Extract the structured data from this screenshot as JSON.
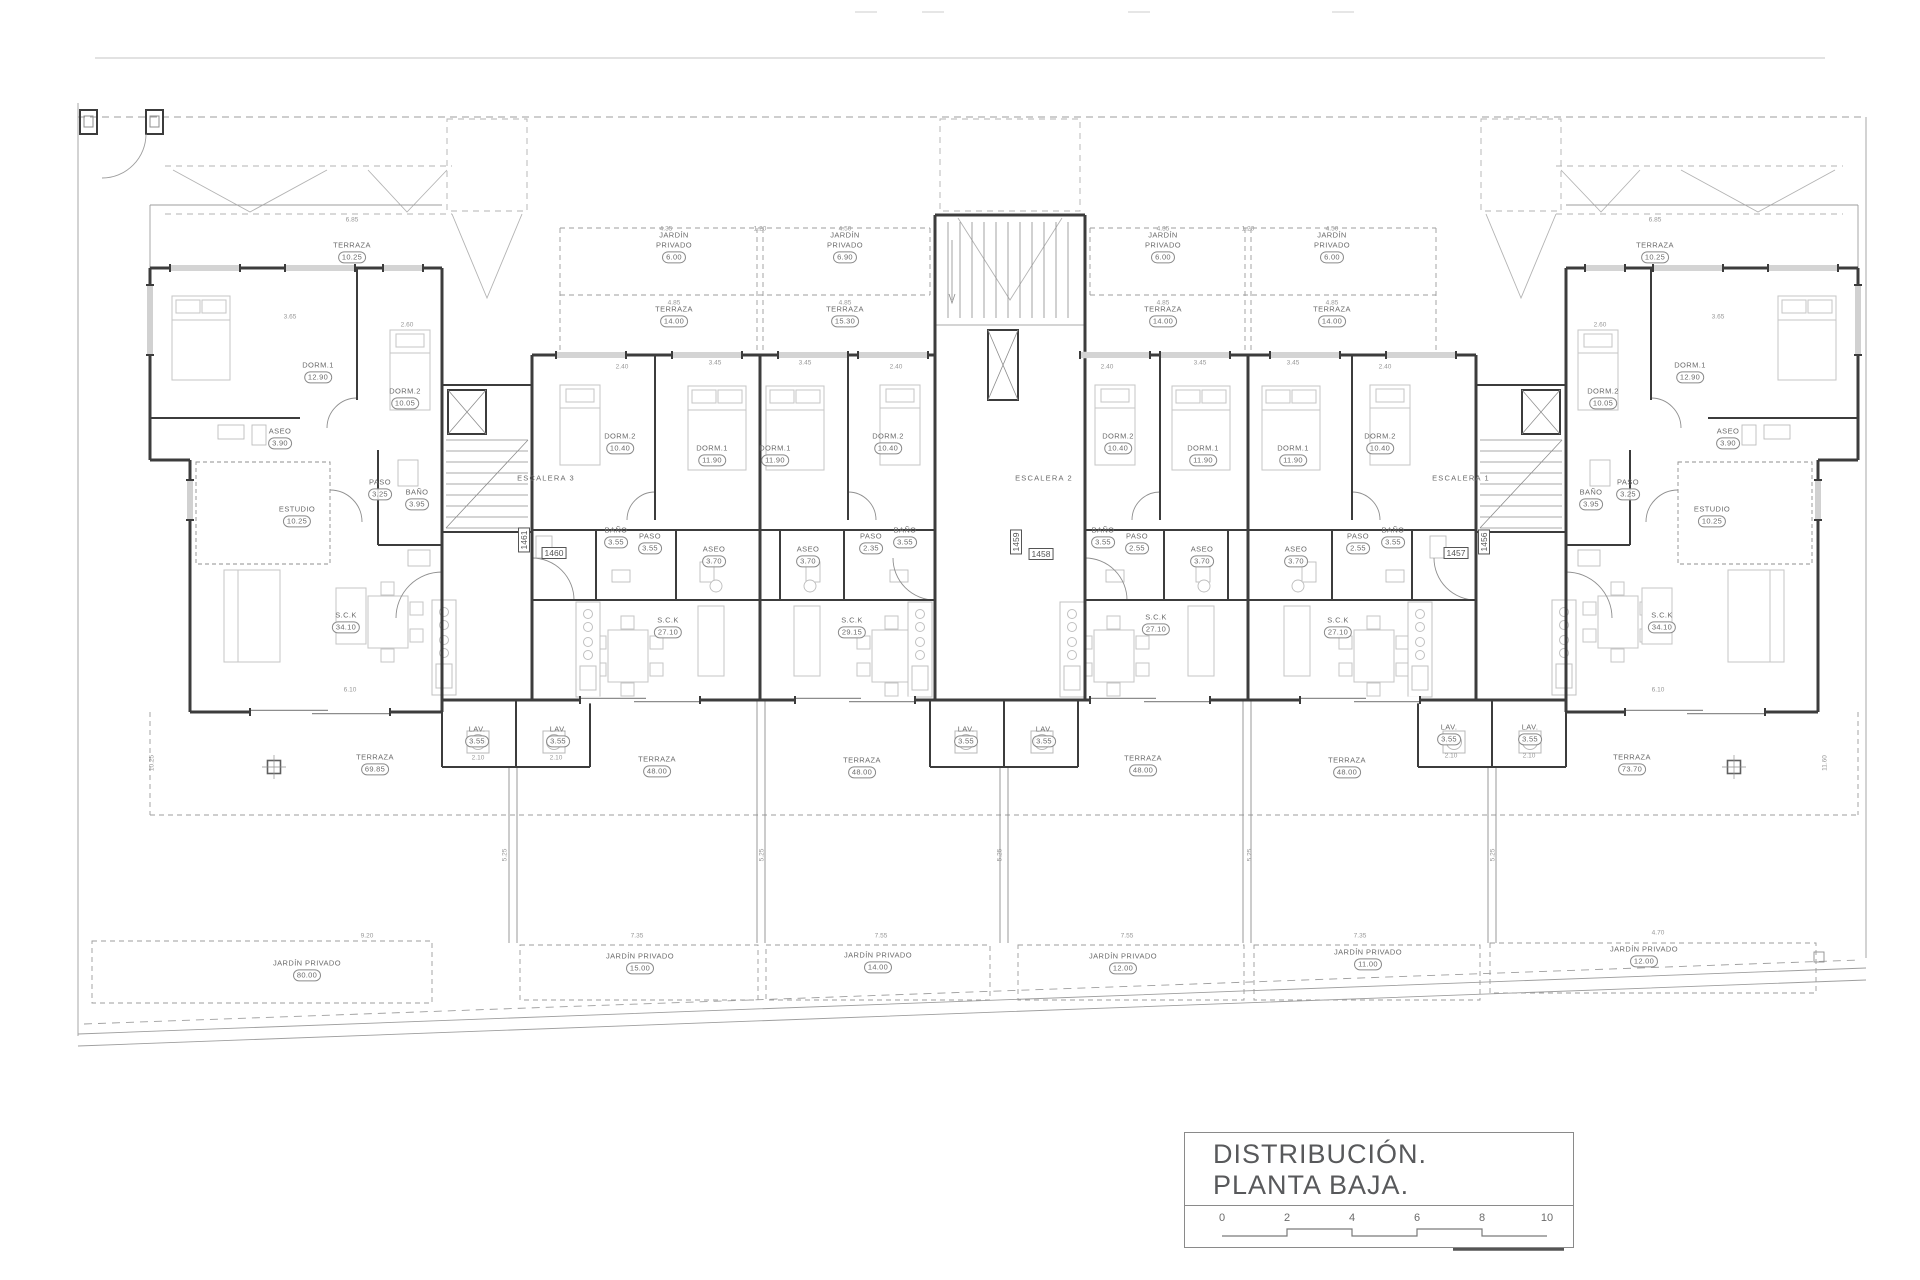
{
  "title_block": {
    "line1": "DISTRIBUCIÓN.",
    "line2": "PLANTA BAJA.",
    "scale_ticks": [
      "0",
      "2",
      "4",
      "6",
      "8",
      "10"
    ]
  },
  "plan": {
    "stair_labels": [
      {
        "text": "ESCALERA 3",
        "x": 546,
        "y": 478
      },
      {
        "text": "ESCALERA 2",
        "x": 1044,
        "y": 478
      },
      {
        "text": "ESCALERA 1",
        "x": 1461,
        "y": 478
      }
    ],
    "unit_tags": [
      {
        "text": "1461",
        "x": 524,
        "y": 540,
        "rot": 90
      },
      {
        "text": "1460",
        "x": 554,
        "y": 553,
        "rot": 0
      },
      {
        "text": "1459",
        "x": 1016,
        "y": 542,
        "rot": 90
      },
      {
        "text": "1458",
        "x": 1041,
        "y": 554,
        "rot": 0
      },
      {
        "text": "1457",
        "x": 1456,
        "y": 553,
        "rot": 0
      },
      {
        "text": "1456",
        "x": 1484,
        "y": 542,
        "rot": 90
      }
    ],
    "room_labels": [
      {
        "text": "TERRAZA",
        "value": "10.25",
        "x": 352,
        "y": 252
      },
      {
        "text": "JARDÍN\nPRIVADO",
        "value": "6.00",
        "x": 674,
        "y": 247
      },
      {
        "text": "JARDÍN\nPRIVADO",
        "value": "6.90",
        "x": 845,
        "y": 247
      },
      {
        "text": "JARDÍN\nPRIVADO",
        "value": "6.00",
        "x": 1163,
        "y": 247
      },
      {
        "text": "JARDÍN\nPRIVADO",
        "value": "6.00",
        "x": 1332,
        "y": 247
      },
      {
        "text": "TERRAZA",
        "value": "10.25",
        "x": 1655,
        "y": 252
      },
      {
        "text": "TERRAZA",
        "value": "14.00",
        "x": 674,
        "y": 316
      },
      {
        "text": "TERRAZA",
        "value": "15.30",
        "x": 845,
        "y": 316
      },
      {
        "text": "TERRAZA",
        "value": "14.00",
        "x": 1163,
        "y": 316
      },
      {
        "text": "TERRAZA",
        "value": "14.00",
        "x": 1332,
        "y": 316
      },
      {
        "text": "DORM.1",
        "value": "12.90",
        "x": 318,
        "y": 372
      },
      {
        "text": "DORM.2",
        "value": "10.05",
        "x": 405,
        "y": 398
      },
      {
        "text": "DORM.2",
        "value": "10.40",
        "x": 620,
        "y": 443
      },
      {
        "text": "DORM.1",
        "value": "11.90",
        "x": 712,
        "y": 455
      },
      {
        "text": "DORM.1",
        "value": "11.90",
        "x": 775,
        "y": 455
      },
      {
        "text": "DORM.2",
        "value": "10.40",
        "x": 888,
        "y": 443
      },
      {
        "text": "DORM.2",
        "value": "10.40",
        "x": 1118,
        "y": 443
      },
      {
        "text": "DORM.1",
        "value": "11.90",
        "x": 1203,
        "y": 455
      },
      {
        "text": "DORM.1",
        "value": "11.90",
        "x": 1293,
        "y": 455
      },
      {
        "text": "DORM.2",
        "value": "10.40",
        "x": 1380,
        "y": 443
      },
      {
        "text": "DORM.2",
        "value": "10.05",
        "x": 1603,
        "y": 398
      },
      {
        "text": "DORM.1",
        "value": "12.90",
        "x": 1690,
        "y": 372
      },
      {
        "text": "ASEO",
        "value": "3.90",
        "x": 280,
        "y": 438
      },
      {
        "text": "ASEO",
        "value": "3.90",
        "x": 1728,
        "y": 438
      },
      {
        "text": "PASO",
        "value": "3.25",
        "x": 380,
        "y": 489
      },
      {
        "text": "BAÑO",
        "value": "3.95",
        "x": 417,
        "y": 499
      },
      {
        "text": "ESTUDIO",
        "value": "10.25",
        "x": 297,
        "y": 516
      },
      {
        "text": "BAÑO",
        "value": "3.95",
        "x": 1591,
        "y": 499
      },
      {
        "text": "PASO",
        "value": "3.25",
        "x": 1628,
        "y": 489
      },
      {
        "text": "ESTUDIO",
        "value": "10.25",
        "x": 1712,
        "y": 516
      },
      {
        "text": "BAÑO",
        "value": "3.55",
        "x": 616,
        "y": 537
      },
      {
        "text": "PASO",
        "value": "3.55",
        "x": 650,
        "y": 543
      },
      {
        "text": "ASEO",
        "value": "3.70",
        "x": 714,
        "y": 556
      },
      {
        "text": "ASEO",
        "value": "3.70",
        "x": 808,
        "y": 556
      },
      {
        "text": "PASO",
        "value": "2.35",
        "x": 871,
        "y": 543
      },
      {
        "text": "BAÑO",
        "value": "3.55",
        "x": 905,
        "y": 537
      },
      {
        "text": "BAÑO",
        "value": "3.55",
        "x": 1103,
        "y": 537
      },
      {
        "text": "PASO",
        "value": "2.55",
        "x": 1137,
        "y": 543
      },
      {
        "text": "ASEO",
        "value": "3.70",
        "x": 1202,
        "y": 556
      },
      {
        "text": "ASEO",
        "value": "3.70",
        "x": 1296,
        "y": 556
      },
      {
        "text": "PASO",
        "value": "2.55",
        "x": 1358,
        "y": 543
      },
      {
        "text": "BAÑO",
        "value": "3.55",
        "x": 1393,
        "y": 537
      },
      {
        "text": "S.C.K",
        "value": "34.10",
        "x": 346,
        "y": 622
      },
      {
        "text": "S.C.K",
        "value": "27.10",
        "x": 668,
        "y": 627
      },
      {
        "text": "S.C.K",
        "value": "29.15",
        "x": 852,
        "y": 627
      },
      {
        "text": "S.C.K",
        "value": "27.10",
        "x": 1156,
        "y": 624
      },
      {
        "text": "S.C.K",
        "value": "27.10",
        "x": 1338,
        "y": 627
      },
      {
        "text": "S.C.K",
        "value": "34.10",
        "x": 1662,
        "y": 622
      },
      {
        "text": "LAV.",
        "value": "3.55",
        "x": 477,
        "y": 736
      },
      {
        "text": "LAV.",
        "value": "3.55",
        "x": 558,
        "y": 736
      },
      {
        "text": "LAV.",
        "value": "3.55",
        "x": 966,
        "y": 736
      },
      {
        "text": "LAV.",
        "value": "3.55",
        "x": 1044,
        "y": 736
      },
      {
        "text": "LAV.",
        "value": "3.55",
        "x": 1449,
        "y": 734
      },
      {
        "text": "LAV.",
        "value": "3.55",
        "x": 1530,
        "y": 734
      },
      {
        "text": "TERRAZA",
        "value": "69.85",
        "x": 375,
        "y": 764
      },
      {
        "text": "TERRAZA",
        "value": "48.00",
        "x": 657,
        "y": 766
      },
      {
        "text": "TERRAZA",
        "value": "48.00",
        "x": 862,
        "y": 767
      },
      {
        "text": "TERRAZA",
        "value": "48.00",
        "x": 1143,
        "y": 765
      },
      {
        "text": "TERRAZA",
        "value": "48.00",
        "x": 1347,
        "y": 767
      },
      {
        "text": "TERRAZA",
        "value": "73.70",
        "x": 1632,
        "y": 764
      },
      {
        "text": "JARDÍN PRIVADO",
        "value": "80.00",
        "x": 307,
        "y": 970
      },
      {
        "text": "JARDÍN PRIVADO",
        "value": "15.00",
        "x": 640,
        "y": 963
      },
      {
        "text": "JARDÍN PRIVADO",
        "value": "14.00",
        "x": 878,
        "y": 962
      },
      {
        "text": "JARDÍN PRIVADO",
        "value": "12.00",
        "x": 1123,
        "y": 963
      },
      {
        "text": "JARDÍN PRIVADO",
        "value": "11.00",
        "x": 1368,
        "y": 959
      },
      {
        "text": "JARDÍN PRIVADO",
        "value": "12.00",
        "x": 1644,
        "y": 956
      }
    ],
    "dim_labels": [
      {
        "text": "4.35",
        "x": 666,
        "y": 229
      },
      {
        "text": "1.20",
        "x": 760,
        "y": 229
      },
      {
        "text": "4.50",
        "x": 845,
        "y": 229
      },
      {
        "text": "4.35",
        "x": 1163,
        "y": 229
      },
      {
        "text": "1.20",
        "x": 1248,
        "y": 229
      },
      {
        "text": "4.50",
        "x": 1332,
        "y": 229
      },
      {
        "text": "4.85",
        "x": 674,
        "y": 303
      },
      {
        "text": "4.85",
        "x": 845,
        "y": 303
      },
      {
        "text": "4.85",
        "x": 1163,
        "y": 303
      },
      {
        "text": "4.85",
        "x": 1332,
        "y": 303
      },
      {
        "text": "6.85",
        "x": 352,
        "y": 220
      },
      {
        "text": "6.85",
        "x": 1655,
        "y": 220
      },
      {
        "text": "3.65",
        "x": 290,
        "y": 317
      },
      {
        "text": "2.60",
        "x": 407,
        "y": 325
      },
      {
        "text": "2.60",
        "x": 1600,
        "y": 325
      },
      {
        "text": "3.65",
        "x": 1718,
        "y": 317
      },
      {
        "text": "2.40",
        "x": 622,
        "y": 367
      },
      {
        "text": "2.40",
        "x": 896,
        "y": 367
      },
      {
        "text": "2.40",
        "x": 1107,
        "y": 367
      },
      {
        "text": "2.40",
        "x": 1385,
        "y": 367
      },
      {
        "text": "3.45",
        "x": 715,
        "y": 363
      },
      {
        "text": "3.45",
        "x": 805,
        "y": 363
      },
      {
        "text": "3.45",
        "x": 1200,
        "y": 363
      },
      {
        "text": "3.45",
        "x": 1293,
        "y": 363
      },
      {
        "text": "6.10",
        "x": 350,
        "y": 690
      },
      {
        "text": "6.10",
        "x": 1658,
        "y": 690
      },
      {
        "text": "9.20",
        "x": 367,
        "y": 936
      },
      {
        "text": "7.35",
        "x": 637,
        "y": 936
      },
      {
        "text": "7.55",
        "x": 881,
        "y": 936
      },
      {
        "text": "7.55",
        "x": 1127,
        "y": 936
      },
      {
        "text": "7.35",
        "x": 1360,
        "y": 936
      },
      {
        "text": "4.70",
        "x": 1658,
        "y": 933
      },
      {
        "text": "2.10",
        "x": 478,
        "y": 758
      },
      {
        "text": "2.10",
        "x": 556,
        "y": 758
      },
      {
        "text": "2.10",
        "x": 1451,
        "y": 756
      },
      {
        "text": "2.10",
        "x": 1529,
        "y": 756
      },
      {
        "text": "5.25",
        "x": 505,
        "y": 855,
        "rot": 90
      },
      {
        "text": "5.25",
        "x": 762,
        "y": 855,
        "rot": 90
      },
      {
        "text": "5.25",
        "x": 1000,
        "y": 855,
        "rot": 90
      },
      {
        "text": "5.25",
        "x": 1250,
        "y": 855,
        "rot": 90
      },
      {
        "text": "5.25",
        "x": 1493,
        "y": 855,
        "rot": 90
      },
      {
        "text": "11.60",
        "x": 1825,
        "y": 763,
        "rot": 90
      },
      {
        "text": "10.25",
        "x": 152,
        "y": 763,
        "rot": 90
      }
    ]
  }
}
